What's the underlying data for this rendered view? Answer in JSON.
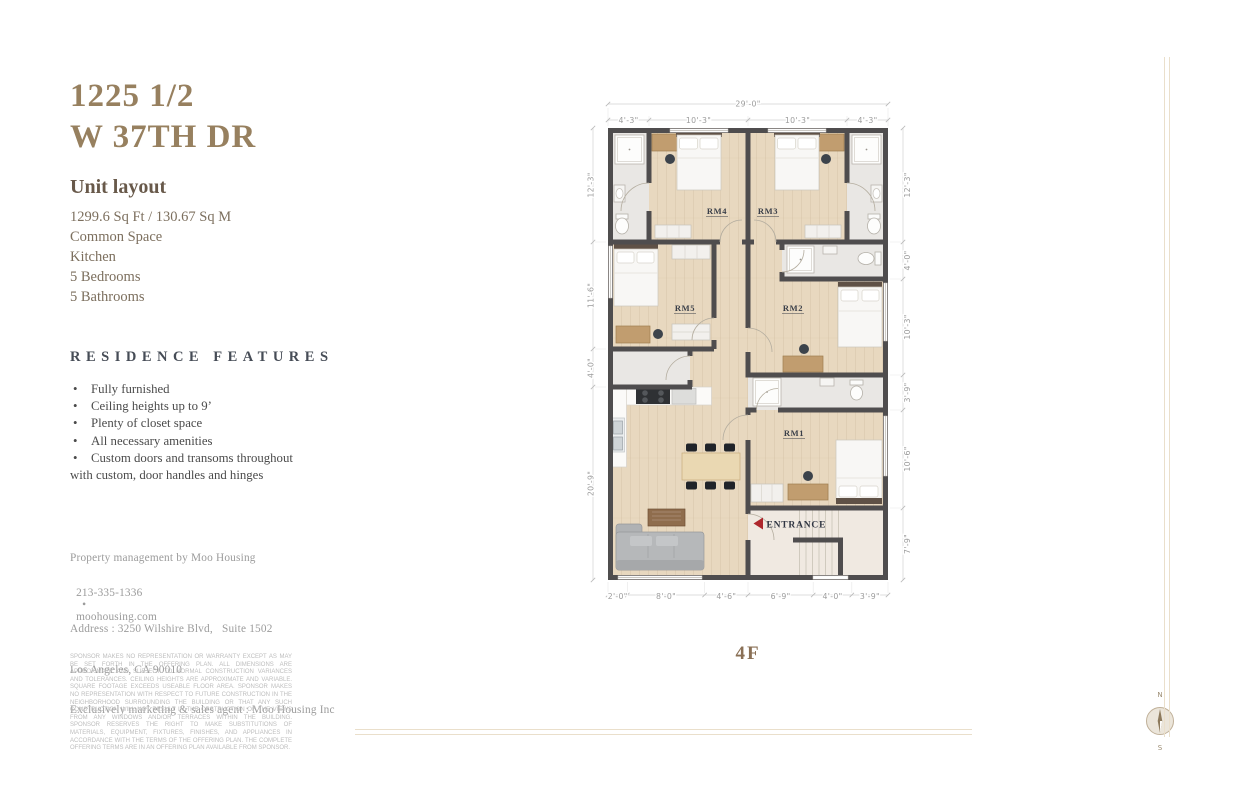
{
  "header": {
    "address_line1": "1225 1/2",
    "address_line2": "W 37TH DR"
  },
  "unit": {
    "title": "Unit layout",
    "details": [
      "1299.6 Sq Ft / 130.67 Sq M",
      "Common Space",
      "Kitchen",
      "5 Bedrooms",
      "5 Bathrooms"
    ]
  },
  "features": {
    "title": "RESIDENCE FEATURES",
    "items": [
      "Fully furnished",
      "Ceiling heights up to 9’",
      "Plenty of closet space",
      "All necessary amenities",
      "Custom doors and transoms throughout with custom,  door handles and hinges"
    ]
  },
  "contact": {
    "management": "Property management by Moo Housing",
    "phone": "213-335-1336",
    "separator": "•",
    "website": "moohousing.com",
    "address_line1": "Address : 3250 Wilshire Blvd,   Suite 1502",
    "address_line2": "Los Angeles, CA 90010",
    "agent": "Exclusively marketing & sales agent : Moo Housing Inc"
  },
  "disclaimer": "SPONSOR MAKES NO REPRESENTATION OR WARRANTY EXCEPT AS MAY BE SET FORTH IN THE OFFERING PLAN. ALL DIMENSIONS ARE APPROXIMATE AND SUBJECT TO NORMAL CONSTRUCTION VARIANCES AND TOLERANCES. CEILING HEIGHTS ARE APPROXIMATE AND VARIABLE. SQUARE FOOTAGE EXCEEDS USEABLE FLOOR AREA. SPONSOR MAKES NO REPRESENTATION WITH RESPECT TO FUTURE CONSTRUCTION IN THE NEIGHBORHOOD SURROUNDING THE BUILDING OR THAT ANY SUCH CONSTRUCTION WILL NOT RESULT IN THE OBSTRUCTION OF THE VIEWS FROM ANY WINDOWS AND/OR TERRACES WITHIN THE BUILDING. SPONSOR RESERVES THE RIGHT TO MAKE SUBSTITUTIONS OF MATERIALS, EQUIPMENT, FIXTURES, FINISHES, AND APPLIANCES IN ACCORDANCE WITH THE TERMS OF THE OFFERING PLAN. THE COMPLETE OFFERING TERMS ARE IN AN OFFERING PLAN AVAILABLE FROM SPONSOR.",
  "floorplan": {
    "floor_label": "4F",
    "entrance_label": "ENTRANCE",
    "rooms": {
      "rm1": "RM1",
      "rm2": "RM2",
      "rm3": "RM3",
      "rm4": "RM4",
      "rm5": "RM5"
    },
    "dims": {
      "overall_top": "29'-0\"",
      "top": [
        "4'-3\"",
        "10'-3\"",
        "10'-3\"",
        "4'-3\""
      ],
      "left": [
        "12'-3\"",
        "11'-6\"",
        "4'-0\"",
        "20'-9\""
      ],
      "right": [
        "12'-3\"",
        "4'-0\"",
        "10'-3\"",
        "3'-9\"",
        "10'-6\"",
        "7'-9\""
      ],
      "bottom": [
        "2'-0\"",
        "8'-0\"",
        "4'-6\"",
        "6'-9\"",
        "4'-0\"",
        "3'-9\""
      ]
    },
    "compass": {
      "north": "N",
      "south": "S"
    }
  },
  "colors": {
    "accent_brown": "#97805f",
    "wall_gray": "#4f4d4e",
    "wood_floor": "#e8d8bf",
    "entrance_red": "#ae272c"
  }
}
